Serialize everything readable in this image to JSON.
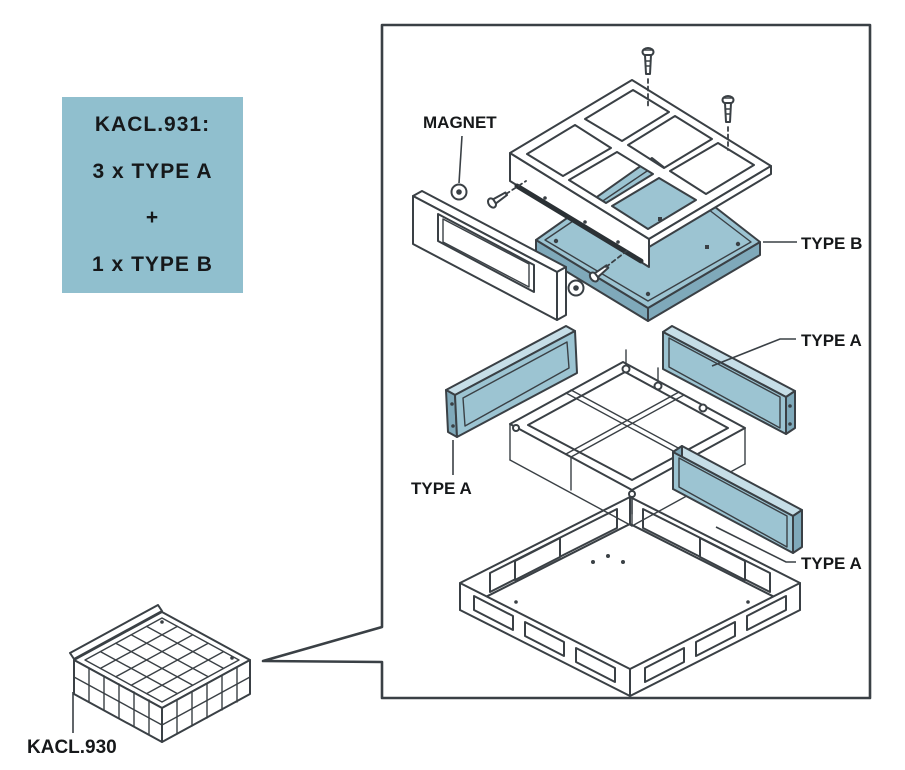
{
  "info_box": {
    "line1": "KACL.931:",
    "line2": "3 x TYPE A",
    "line3": "+",
    "line4": "1 x TYPE B"
  },
  "labels": {
    "magnet": "MAGNET",
    "type_b": "TYPE B",
    "type_a_right_upper": "TYPE A",
    "type_a_left": "TYPE A",
    "type_a_right_lower": "TYPE A",
    "kacl930": "KACL.930"
  },
  "colors": {
    "info_box_bg": "#90BFCE",
    "panel_blue": "#9CC4D2",
    "panel_blue_light": "#C6DEE7",
    "panel_blue_dark": "#7FA9BA",
    "magnet_strip": "#2B3135",
    "line": "#3A4045",
    "text": "#16181A",
    "bg": "#FFFFFF"
  }
}
